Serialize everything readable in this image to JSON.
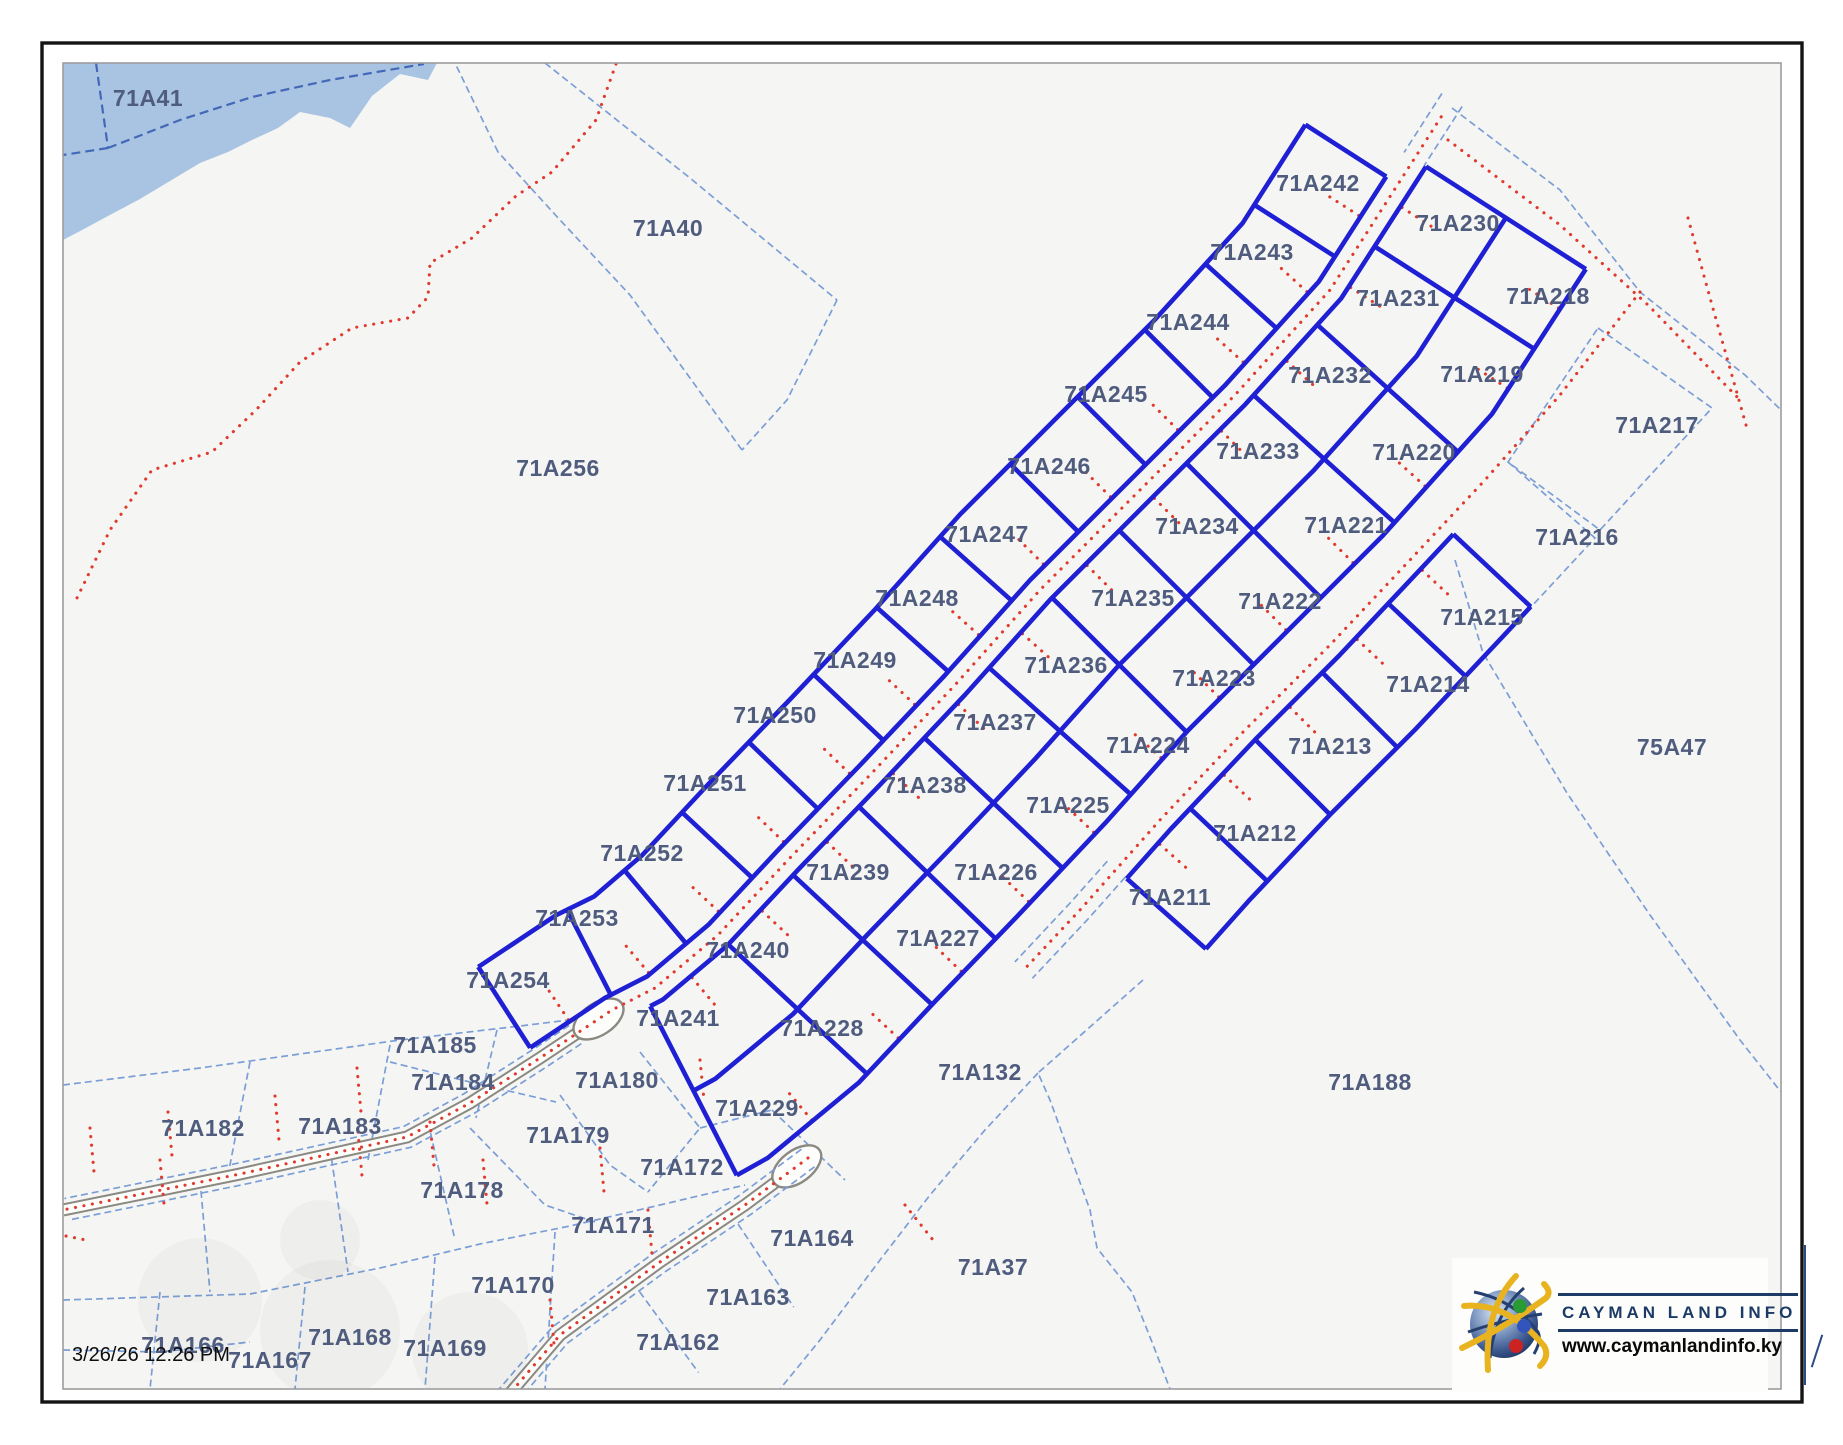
{
  "map": {
    "timestamp": "3/26/26 12:26 PM",
    "logo": {
      "title": "CAYMAN LAND INFO",
      "url": "www.caymanlandinfo.ky"
    },
    "colors": {
      "background": "#f5f6f4",
      "water": "#a9c4e2",
      "parcel_thick": "#1f1fd4",
      "parcel_thin": "#7c9ed6",
      "label": "#4f5c7e",
      "red_dotted": "#e03a2e",
      "road_casing": "#8a8a82",
      "logo_navy": "#1c3a66"
    }
  },
  "parcels": [
    {
      "id": "71A242",
      "x": 1318,
      "y": 183,
      "tier": "subdivision"
    },
    {
      "id": "71A243",
      "x": 1252,
      "y": 252,
      "tier": "subdivision"
    },
    {
      "id": "71A244",
      "x": 1188,
      "y": 322,
      "tier": "subdivision"
    },
    {
      "id": "71A245",
      "x": 1106,
      "y": 394,
      "tier": "subdivision"
    },
    {
      "id": "71A246",
      "x": 1049,
      "y": 466,
      "tier": "subdivision"
    },
    {
      "id": "71A247",
      "x": 987,
      "y": 534,
      "tier": "subdivision"
    },
    {
      "id": "71A248",
      "x": 917,
      "y": 598,
      "tier": "subdivision"
    },
    {
      "id": "71A249",
      "x": 855,
      "y": 660,
      "tier": "subdivision"
    },
    {
      "id": "71A250",
      "x": 775,
      "y": 715,
      "tier": "subdivision"
    },
    {
      "id": "71A251",
      "x": 705,
      "y": 783,
      "tier": "subdivision"
    },
    {
      "id": "71A252",
      "x": 642,
      "y": 853,
      "tier": "subdivision"
    },
    {
      "id": "71A253",
      "x": 577,
      "y": 918,
      "tier": "subdivision"
    },
    {
      "id": "71A254",
      "x": 508,
      "y": 980,
      "tier": "subdivision"
    },
    {
      "id": "71A230",
      "x": 1458,
      "y": 223,
      "tier": "subdivision"
    },
    {
      "id": "71A231",
      "x": 1398,
      "y": 298,
      "tier": "subdivision"
    },
    {
      "id": "71A232",
      "x": 1330,
      "y": 375,
      "tier": "subdivision"
    },
    {
      "id": "71A233",
      "x": 1258,
      "y": 451,
      "tier": "subdivision"
    },
    {
      "id": "71A234",
      "x": 1197,
      "y": 526,
      "tier": "subdivision"
    },
    {
      "id": "71A235",
      "x": 1133,
      "y": 598,
      "tier": "subdivision"
    },
    {
      "id": "71A236",
      "x": 1066,
      "y": 665,
      "tier": "subdivision"
    },
    {
      "id": "71A237",
      "x": 995,
      "y": 722,
      "tier": "subdivision"
    },
    {
      "id": "71A238",
      "x": 925,
      "y": 785,
      "tier": "subdivision"
    },
    {
      "id": "71A239",
      "x": 848,
      "y": 872,
      "tier": "subdivision"
    },
    {
      "id": "71A240",
      "x": 748,
      "y": 950,
      "tier": "subdivision"
    },
    {
      "id": "71A241",
      "x": 678,
      "y": 1018,
      "tier": "subdivision"
    },
    {
      "id": "71A218",
      "x": 1548,
      "y": 296,
      "tier": "subdivision"
    },
    {
      "id": "71A219",
      "x": 1482,
      "y": 374,
      "tier": "subdivision"
    },
    {
      "id": "71A220",
      "x": 1414,
      "y": 452,
      "tier": "subdivision"
    },
    {
      "id": "71A221",
      "x": 1346,
      "y": 525,
      "tier": "subdivision"
    },
    {
      "id": "71A222",
      "x": 1280,
      "y": 601,
      "tier": "subdivision"
    },
    {
      "id": "71A223",
      "x": 1214,
      "y": 678,
      "tier": "subdivision"
    },
    {
      "id": "71A224",
      "x": 1148,
      "y": 745,
      "tier": "subdivision"
    },
    {
      "id": "71A225",
      "x": 1068,
      "y": 805,
      "tier": "subdivision"
    },
    {
      "id": "71A226",
      "x": 996,
      "y": 872,
      "tier": "subdivision"
    },
    {
      "id": "71A227",
      "x": 938,
      "y": 938,
      "tier": "subdivision"
    },
    {
      "id": "71A228",
      "x": 822,
      "y": 1028,
      "tier": "subdivision"
    },
    {
      "id": "71A229",
      "x": 757,
      "y": 1108,
      "tier": "subdivision"
    },
    {
      "id": "71A215",
      "x": 1482,
      "y": 617,
      "tier": "subdivision"
    },
    {
      "id": "71A214",
      "x": 1428,
      "y": 684,
      "tier": "subdivision"
    },
    {
      "id": "71A213",
      "x": 1330,
      "y": 746,
      "tier": "subdivision"
    },
    {
      "id": "71A212",
      "x": 1255,
      "y": 833,
      "tier": "subdivision"
    },
    {
      "id": "71A211",
      "x": 1170,
      "y": 897,
      "tier": "subdivision"
    },
    {
      "id": "71A41",
      "x": 148,
      "y": 98,
      "tier": "context"
    },
    {
      "id": "71A40",
      "x": 668,
      "y": 228,
      "tier": "context"
    },
    {
      "id": "71A256",
      "x": 558,
      "y": 468,
      "tier": "context"
    },
    {
      "id": "71A217",
      "x": 1657,
      "y": 425,
      "tier": "context"
    },
    {
      "id": "71A216",
      "x": 1577,
      "y": 537,
      "tier": "context"
    },
    {
      "id": "75A47",
      "x": 1672,
      "y": 747,
      "tier": "context"
    },
    {
      "id": "71A188",
      "x": 1370,
      "y": 1082,
      "tier": "context"
    },
    {
      "id": "71A132",
      "x": 980,
      "y": 1072,
      "tier": "context"
    },
    {
      "id": "71A37",
      "x": 993,
      "y": 1267,
      "tier": "context"
    },
    {
      "id": "71A185",
      "x": 435,
      "y": 1045,
      "tier": "context"
    },
    {
      "id": "71A184",
      "x": 453,
      "y": 1082,
      "tier": "context"
    },
    {
      "id": "71A183",
      "x": 340,
      "y": 1126,
      "tier": "context"
    },
    {
      "id": "71A182",
      "x": 203,
      "y": 1128,
      "tier": "context"
    },
    {
      "id": "71A180",
      "x": 617,
      "y": 1080,
      "tier": "context"
    },
    {
      "id": "71A179",
      "x": 568,
      "y": 1135,
      "tier": "context"
    },
    {
      "id": "71A178",
      "x": 462,
      "y": 1190,
      "tier": "context"
    },
    {
      "id": "71A172",
      "x": 682,
      "y": 1167,
      "tier": "context"
    },
    {
      "id": "71A171",
      "x": 613,
      "y": 1225,
      "tier": "context"
    },
    {
      "id": "71A170",
      "x": 513,
      "y": 1285,
      "tier": "context"
    },
    {
      "id": "71A169",
      "x": 445,
      "y": 1348,
      "tier": "context"
    },
    {
      "id": "71A168",
      "x": 350,
      "y": 1337,
      "tier": "context"
    },
    {
      "id": "71A167",
      "x": 270,
      "y": 1360,
      "tier": "context"
    },
    {
      "id": "71A166",
      "x": 183,
      "y": 1345,
      "tier": "context"
    },
    {
      "id": "71A164",
      "x": 812,
      "y": 1238,
      "tier": "context"
    },
    {
      "id": "71A163",
      "x": 748,
      "y": 1297,
      "tier": "context"
    },
    {
      "id": "71A162",
      "x": 678,
      "y": 1342,
      "tier": "context"
    }
  ]
}
